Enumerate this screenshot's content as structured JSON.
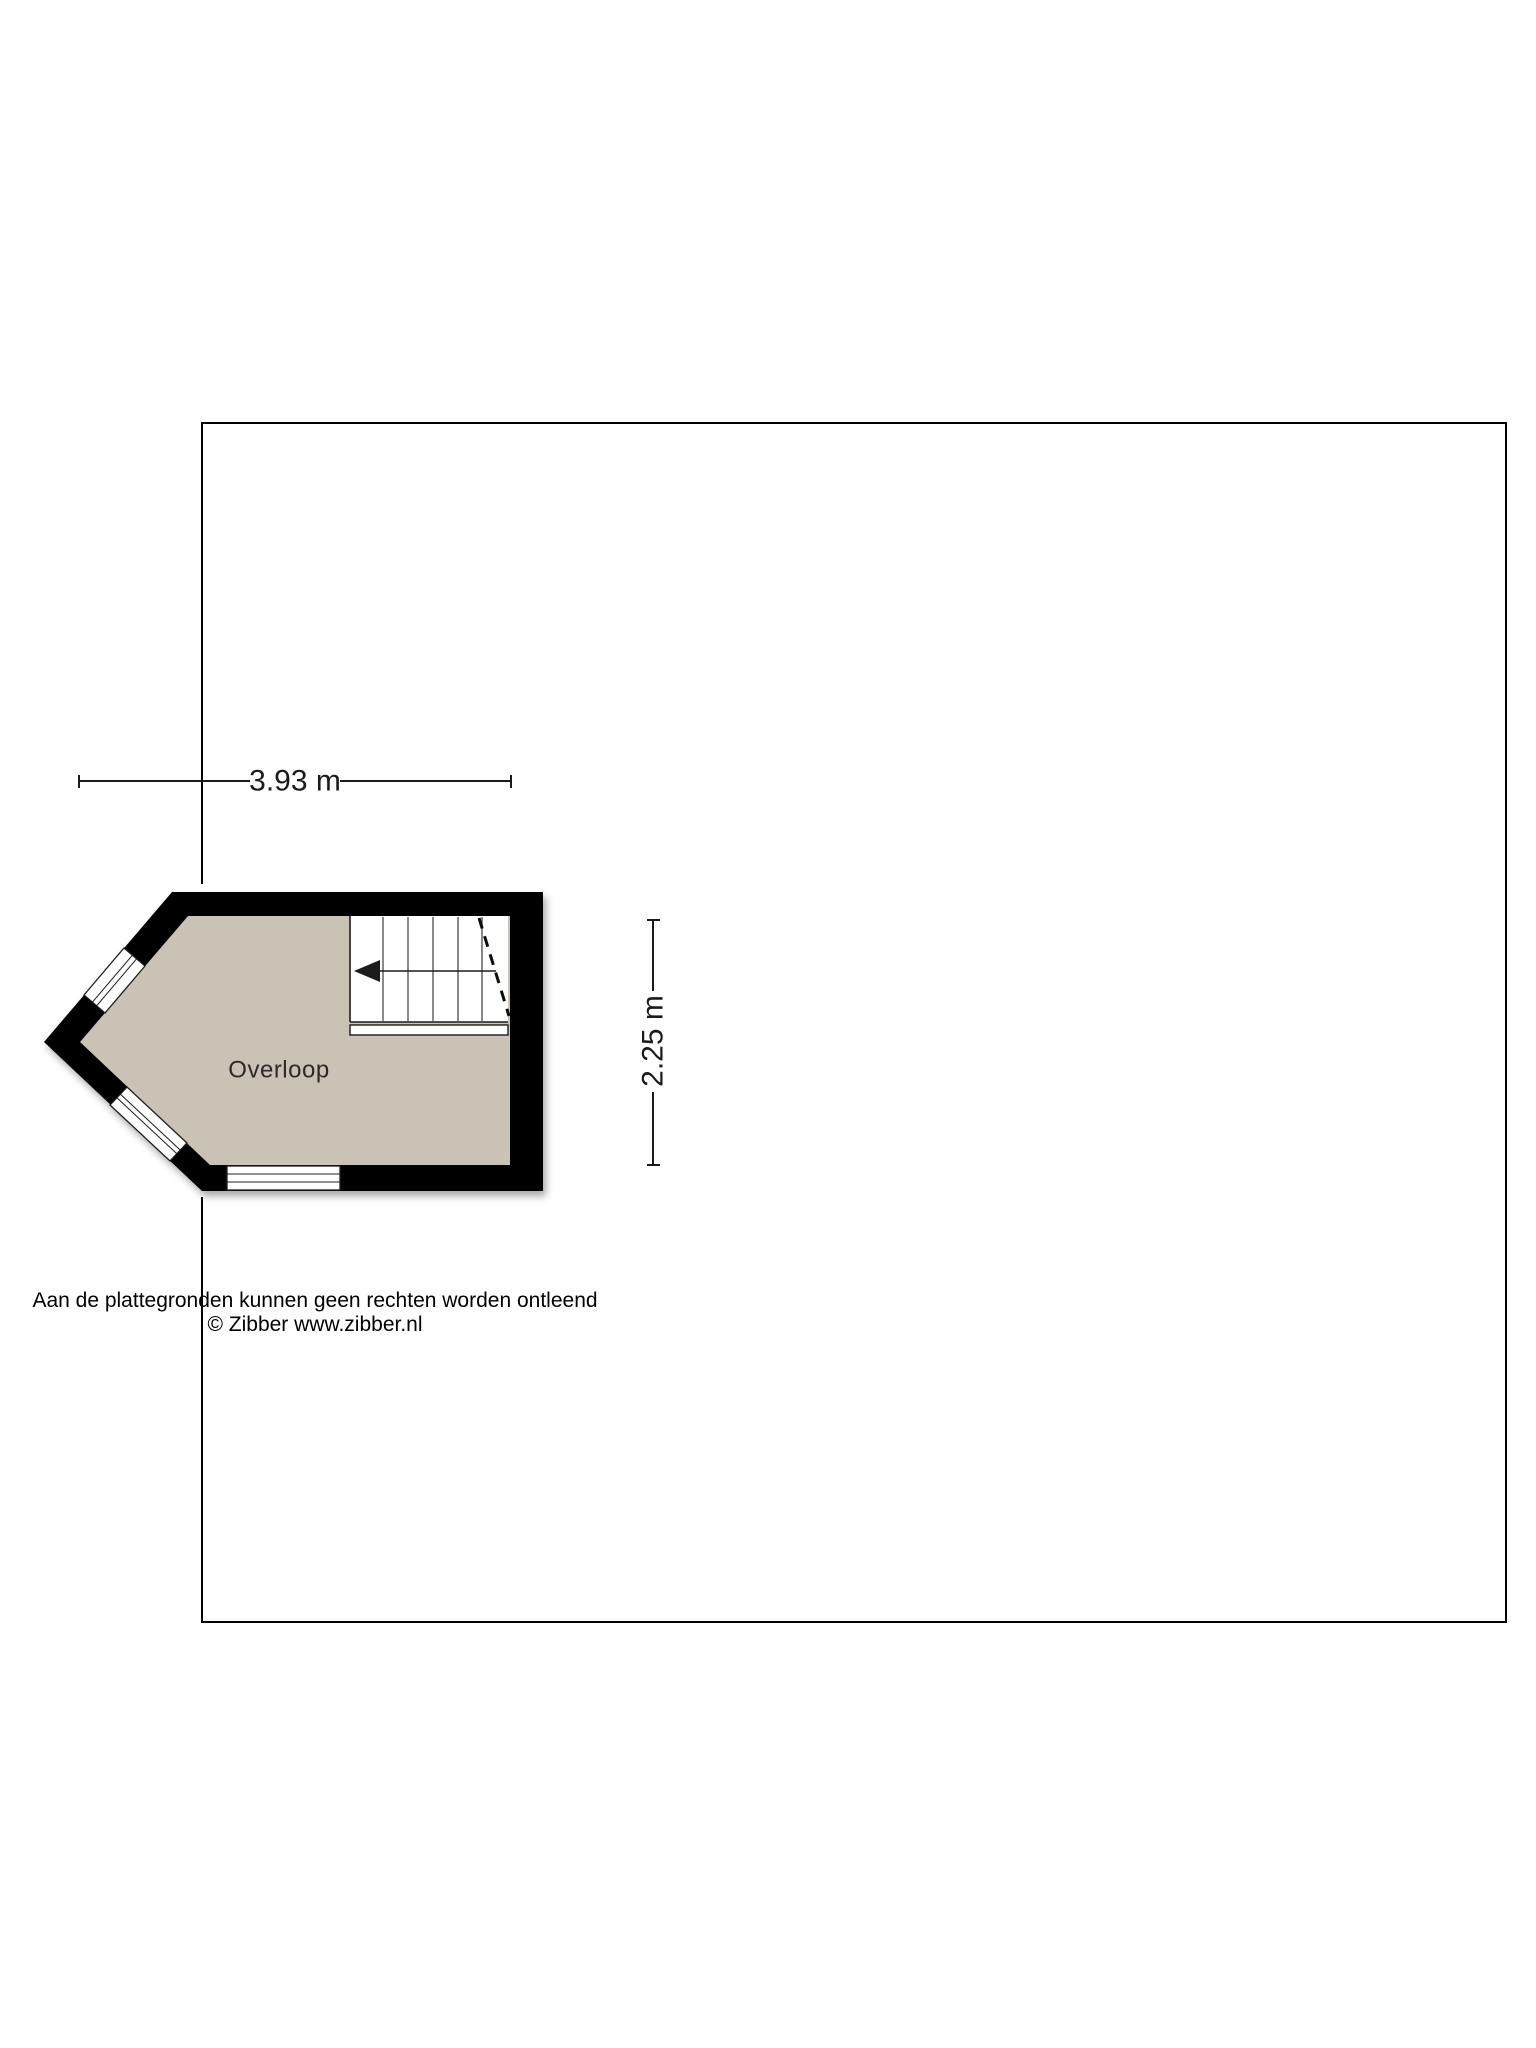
{
  "dimensions": {
    "width_label": "3.93 m",
    "depth_label": "2.25 m"
  },
  "room": {
    "label": "Overloop"
  },
  "colors": {
    "floor_fill": "#cac2b4",
    "wall_fill": "#000000",
    "line": "#1a1a1a",
    "background": "#ffffff"
  },
  "footer": {
    "disclaimer": "Aan de plattegronden kunnen geen rechten worden ontleend",
    "copyright": "© Zibber www.zibber.nl"
  }
}
